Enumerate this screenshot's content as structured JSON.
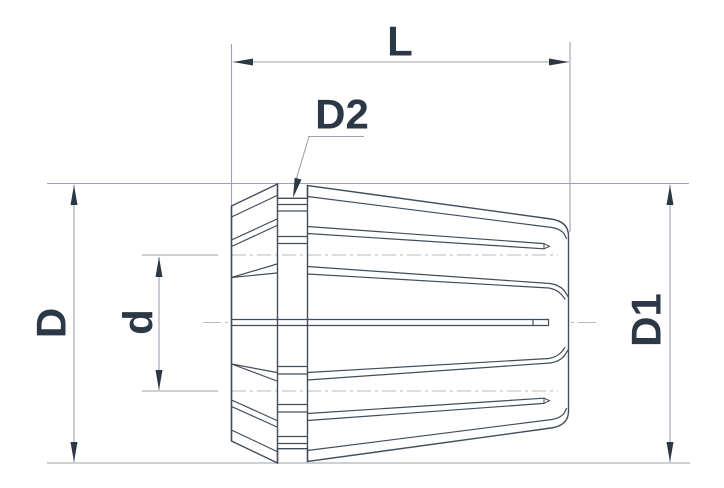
{
  "drawing": {
    "title": "ER collet dimensional drawing",
    "labels": {
      "length": "L",
      "neck_diameter": "D2",
      "outer_diameter_left": "D",
      "bore_diameter": "d",
      "outer_diameter_right": "D1"
    },
    "colors": {
      "background": "#ffffff",
      "text_and_arrows": "#2c3845",
      "part_outline": "#414d5a",
      "construction_lines": "#9aa3ad",
      "hidden_lines": "#b3bac2"
    }
  }
}
